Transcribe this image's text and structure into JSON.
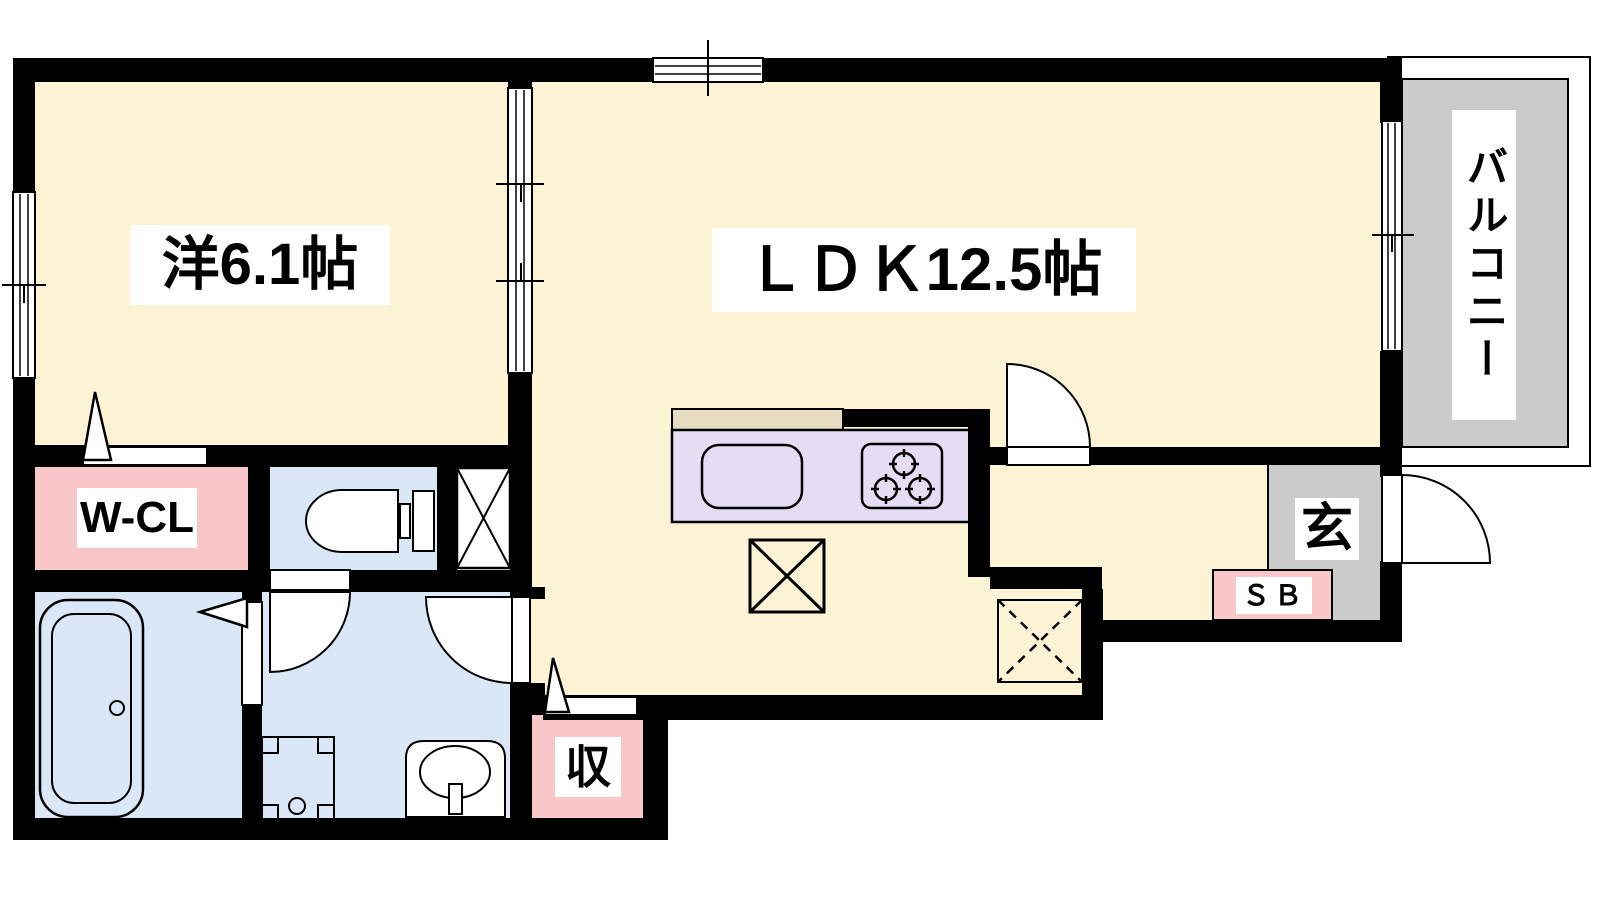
{
  "floorplan": {
    "type": "apartment-floor-plan-1LDK",
    "rooms": {
      "western_room": {
        "label": "洋6.1帖",
        "size_tatami": 6.1
      },
      "ldk": {
        "label": "ＬＤＫ12.5帖",
        "size_tatami": 12.5
      },
      "balcony": {
        "label": "バルコニー"
      },
      "walk_in_closet": {
        "label": "W-CL"
      },
      "entrance": {
        "label": "玄"
      },
      "shoe_box": {
        "label": "ＳＢ"
      },
      "storage": {
        "label": "収"
      }
    },
    "colors": {
      "cream": "#FCF3D5",
      "blue": "#D9E7F7",
      "pink": "#F9C6CA",
      "lavender": "#E6DDF4",
      "tan": "#E7DCC2",
      "gray": "#CBCBCB",
      "wall": "#000000",
      "labelbg": "#FFFFFF"
    }
  }
}
